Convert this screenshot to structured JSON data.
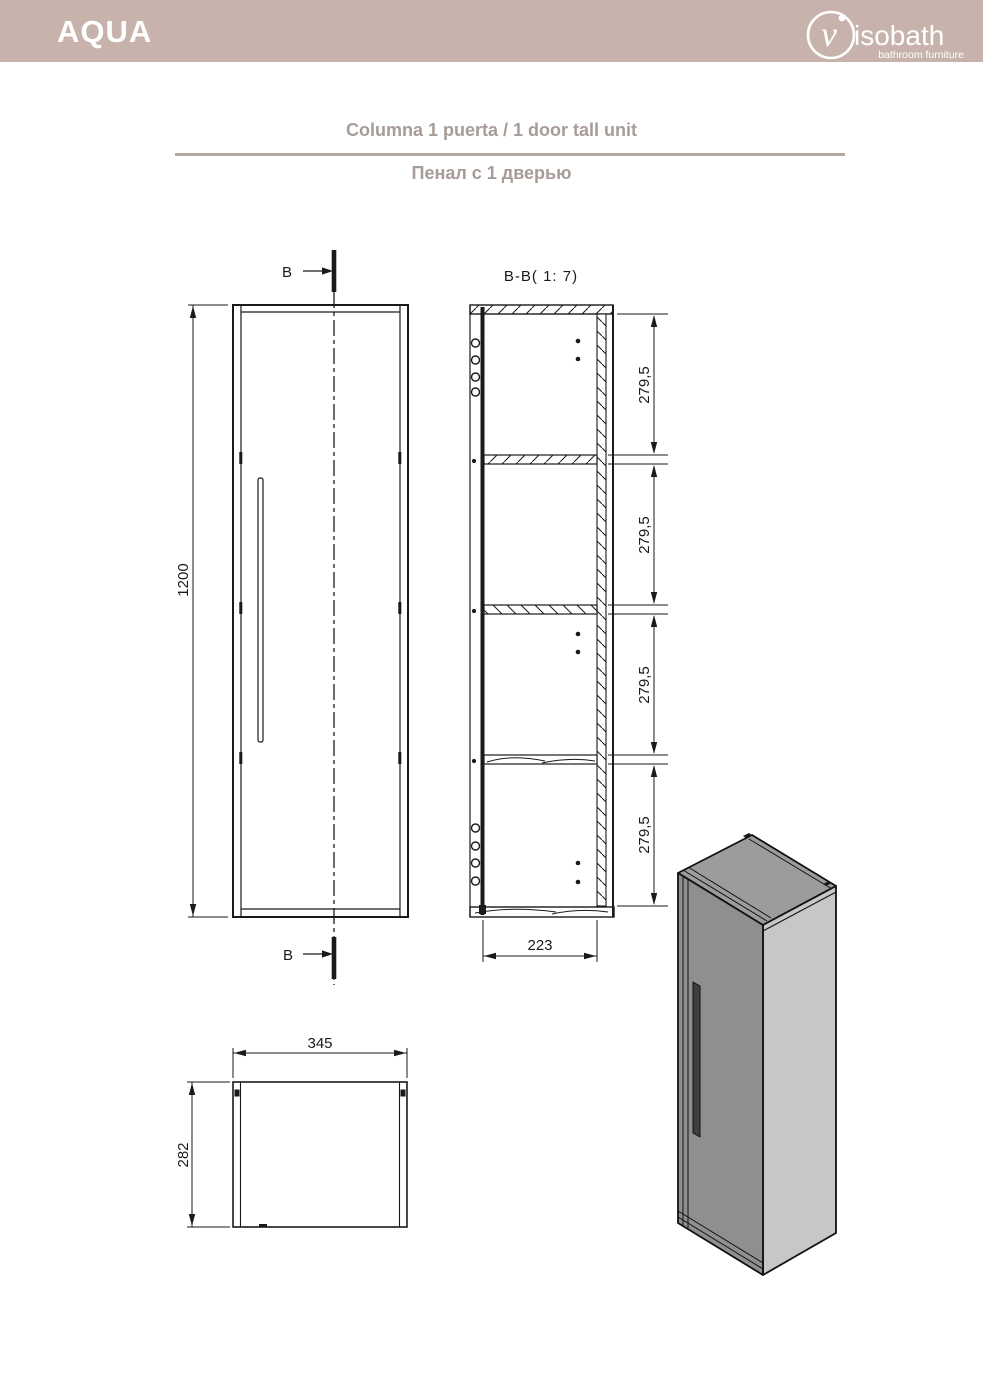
{
  "header": {
    "brand": "AQUA",
    "logo": {
      "initial": "v",
      "name": "isobath",
      "tagline": "bathroom furniture"
    }
  },
  "titles": {
    "es_en": "Columna 1 puerta / 1 door tall unit",
    "ru": "Пенал с 1 дверью"
  },
  "views": {
    "section_label": "B-B( 1: 7)",
    "cut_label_top": "B",
    "cut_label_bottom": "B",
    "front_view": {
      "height_dim": "1200"
    },
    "section_view": {
      "compartment_dims": [
        "279,5",
        "279,5",
        "279,5",
        "279,5"
      ],
      "width_dim": "223"
    },
    "bottom_view": {
      "width_dim": "345",
      "depth_dim": "282"
    }
  },
  "colors": {
    "header_bg": "#c7b3ab",
    "title_text": "#a79c97",
    "divider": "#b4a7a1",
    "line": "#1a1a1a",
    "iso_top": "#9c9c9c",
    "iso_front": "#8f8f8f",
    "iso_side": "#c7c7c7",
    "iso_handle": "#3f3f3f"
  }
}
